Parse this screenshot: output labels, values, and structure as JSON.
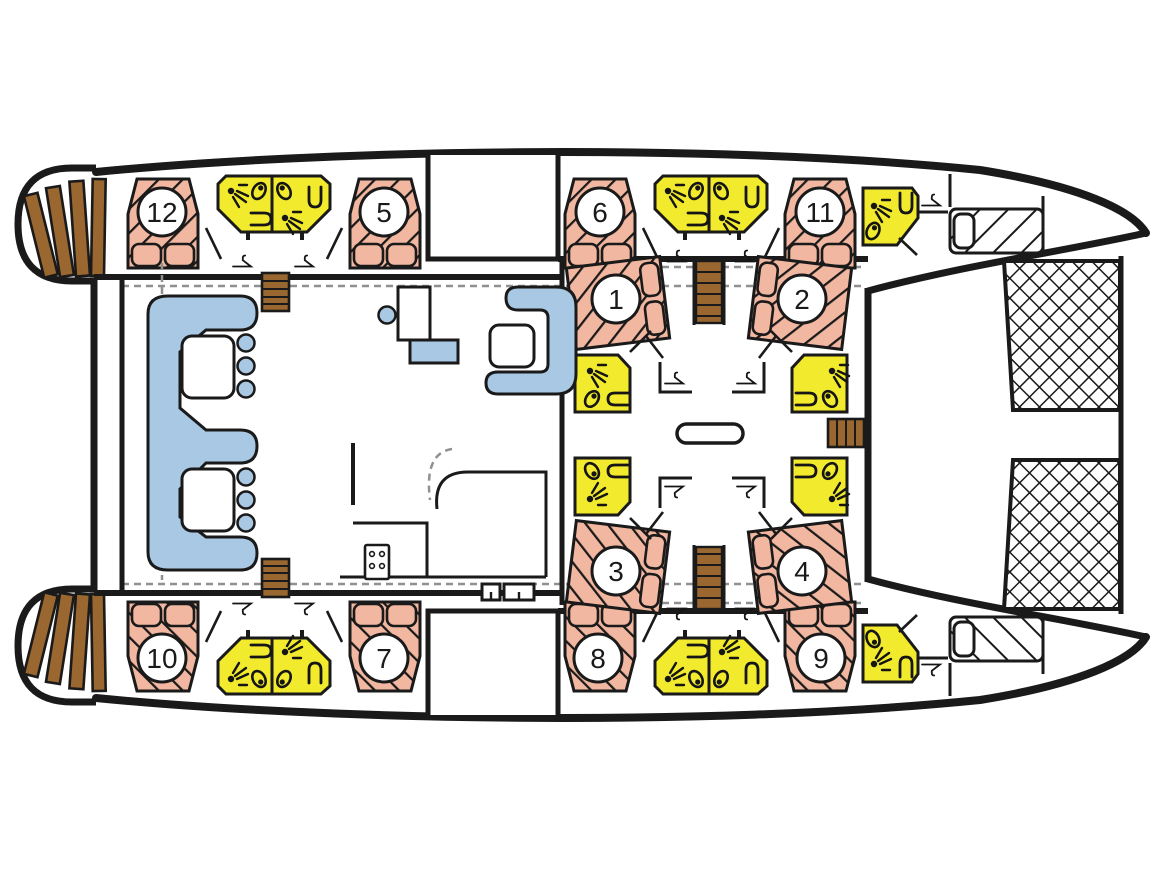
{
  "diagram": {
    "type": "yacht-deck-plan",
    "vessel": "catamaran-accommodation-layout"
  },
  "cabins": [
    {
      "label": "1"
    },
    {
      "label": "2"
    },
    {
      "label": "3"
    },
    {
      "label": "4"
    },
    {
      "label": "5"
    },
    {
      "label": "6"
    },
    {
      "label": "7"
    },
    {
      "label": "8"
    },
    {
      "label": "9"
    },
    {
      "label": "10"
    },
    {
      "label": "11"
    },
    {
      "label": "12"
    }
  ],
  "colors": {
    "bed_fill": "#f2b7a0",
    "bathroom_fill": "#f2ea2d",
    "seating_fill": "#a8c8e4",
    "wood_fill": "#99672f",
    "outline": "#1a1a1a",
    "dashed_line": "#909090",
    "background": "#ffffff"
  },
  "icons": [
    "shower-icon",
    "toilet-icon",
    "sink-icon",
    "hanger-icon",
    "stairs",
    "stern-steps",
    "trampoline-net",
    "double-bed",
    "crew-berth",
    "salon-sofa",
    "table",
    "galley-stove",
    "corridor-bench"
  ]
}
